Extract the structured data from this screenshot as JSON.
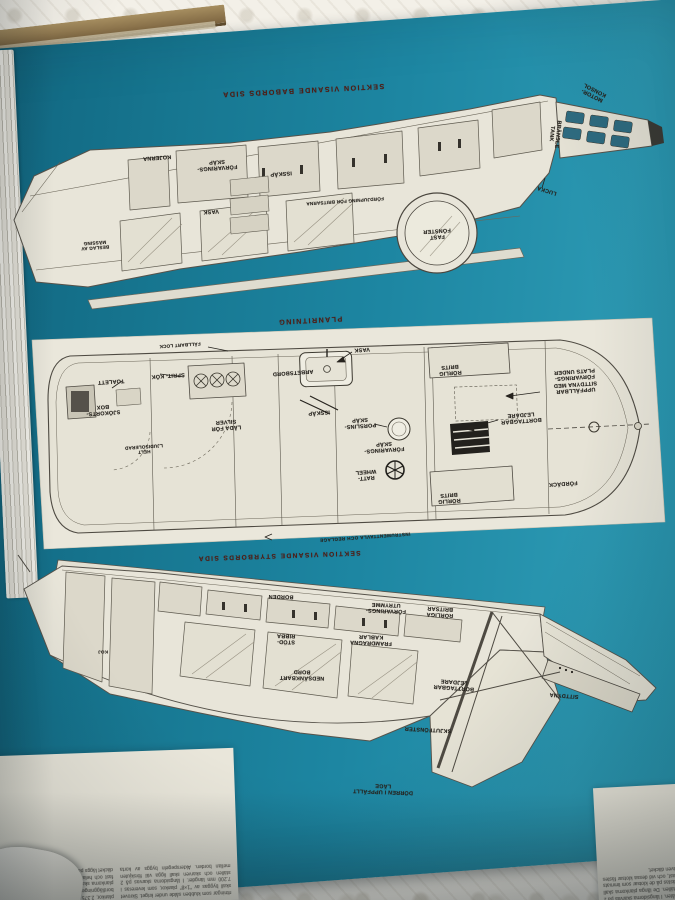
{
  "colors": {
    "page_teal": "#1d86a2",
    "heading_maroon": "#4e1d15",
    "paper": "#e8e5d9"
  },
  "top": {
    "heading": "SEKTION VISANDE BABORDS SIDA",
    "labels": {
      "motor_konsol": "MOTOR- KONSOL",
      "bransle_tank": "BRÄNSLE TANK",
      "lucka": "LUCKA",
      "kojerna": "KOJERNA",
      "forvarings_skap": "FÖRVARINGS- SKÅP",
      "isskap": "ISSKÅP",
      "fordjupning": "FÖRDJUPNING FÖR BRITSARNA",
      "vask": "VASK",
      "fast_fonster": "FAST FÖNSTER",
      "massing": "BESLAG AV MÄSSING"
    }
  },
  "plan": {
    "heading": "PLANRITNING",
    "labels": {
      "fallbart_lock": "FÄLLBART LOCK",
      "toalett": "TOALETT",
      "sjokorts_box": "SJÖKORTS- BOX",
      "sprit_kok": "SPRIT- KÖK",
      "lada_silver": "LÅDA FÖR SILVER",
      "ljudisolerad": "HELT LJUDISOLERAD",
      "vask": "VASK",
      "arbetsbord": "ARBETSBORD",
      "isskap": "ISSKÅP",
      "porslins_skap": "PORSLINS- SKÅP",
      "forvarings_skap": "FÖRVARINGS- SKÅP",
      "ratt": "RATT- WHEEL",
      "rorlig_brits_over": "RÖRLIG BRITS",
      "rorlig_brits_under": "RÖRLIG BRITS",
      "borttagbar_lejdare": "BORTTAGBAR LEJDARE",
      "fordack": "FÖRDÄCK",
      "uppfallbar_sittdyna": "UPPFÄLLBAR SITTDYNA MED FÖRVARINGS- PLATS UNDER",
      "instrument": "INSTRUMENTTAVLA OCH REGLAGE"
    }
  },
  "bottom": {
    "heading": "SEKTION VISANDE STYRBORDS SIDA",
    "labels": {
      "borden": "BORDEN",
      "forvarings_utrymme": "FÖRVARINGS- UTRYMME",
      "rorliga_britsar": "RÖRLIGA BRITSAR",
      "framdragna_kablar": "FRAMDRAGNA KABLAR",
      "stod_ribba": "STÖD- RIBBA",
      "nedsankbart_bord": "NEDSÄNKBART BORD",
      "koj": "KOJ",
      "skjutfonster": "SKJUTFÖNSTER",
      "sittdyna": "SITTDYNA",
      "borttagbar_lejdare": "BORTTAGBAR LEJDARE",
      "dorren": "DÖRREN I UPPFÄLLT LÄGE"
    }
  },
  "article": {
    "left": "ritningar som klubben sålde under kriget. Skrovet skall byggas av \"1×8\" plankor, som levereras i 7.200 mm längder. I långsidorna skarvas på 2 ställen och skarven skall ligga väl förskjuten mellan borden. Akterspegeln byggs av korta plankor, 2.375 mm, och vid dessa klotsar fästas bordläggningen med skruv och lim. De långa plankorna skall fästas på de klotsar som limmats fast och hela skrovet bör därefter putsas innan däcket läggs på plats och fästes.",
    "right": "båten. I långsidorna skarvas på 2 ställen. De långa plankorna skall fästas på de klotsar som limmats fast, och vid dessa klotsar fästes även däcket."
  }
}
